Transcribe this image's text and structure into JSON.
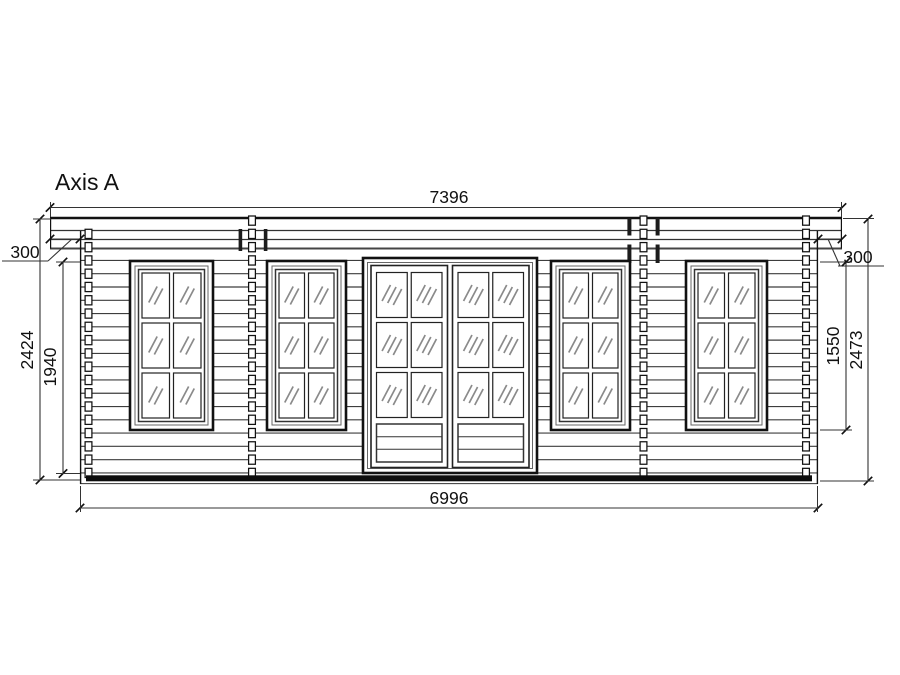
{
  "title": "Axis A",
  "dimensions": {
    "top_width": "7396",
    "bottom_width": "6996",
    "left_overhang": "300",
    "right_overhang": "300",
    "left_total_height": "2424",
    "left_opening_height": "1940",
    "right_window_height": "1550",
    "right_total_height": "2473"
  },
  "colors": {
    "line": "#111111",
    "log_line": "#3d3d3d",
    "dim_line": "#333333",
    "inner_frame": "#666666",
    "glass_mark": "#8a8a8a",
    "batten": "#1c1c1c",
    "floor_band": "#0d0d0d",
    "background": "#ffffff"
  },
  "geometry": {
    "canvas": {
      "w": 900,
      "h": 675
    },
    "roof": {
      "x1": 50,
      "x2": 842,
      "yTop": 218,
      "line1": 230.5,
      "line2": 239.5,
      "yBot": 248.5
    },
    "wall": {
      "x1": 80,
      "x2": 818,
      "edgeTop": 231,
      "yBot": 484
    },
    "courses": {
      "y0": 220.6,
      "step": 13.28,
      "count": 20,
      "firstLogRow": 3
    },
    "floor": {
      "x1": 86,
      "x2": 812,
      "y": 475.3,
      "h": 6,
      "lineY": 483.6
    },
    "squareCols": [
      {
        "x": 88.5,
        "start": 1
      },
      {
        "x": 252,
        "start": 0
      },
      {
        "x": 643.5,
        "start": 0
      },
      {
        "x": 806,
        "start": 0
      }
    ],
    "square": {
      "w": 6.8,
      "h": 9.2
    },
    "battens": [
      {
        "x": 238.6,
        "y": 229,
        "w": 3.6,
        "h": 22
      },
      {
        "x": 263.8,
        "y": 229,
        "w": 3.6,
        "h": 22
      },
      {
        "x": 627.4,
        "y": 218,
        "w": 4,
        "h": 17.5
      },
      {
        "x": 655.6,
        "y": 218,
        "w": 4,
        "h": 17.5
      },
      {
        "x": 627.4,
        "y": 244.5,
        "w": 4,
        "h": 18.5
      },
      {
        "x": 655.6,
        "y": 244.5,
        "w": 4,
        "h": 18.5
      }
    ],
    "windows": [
      {
        "x": 130,
        "w": 83
      },
      {
        "x": 267,
        "w": 79
      },
      {
        "x": 551,
        "w": 79
      },
      {
        "x": 686,
        "w": 81
      }
    ],
    "windowY": 261,
    "windowH": 169,
    "door": {
      "x": 363,
      "y": 258,
      "w": 174,
      "h": 215
    }
  }
}
